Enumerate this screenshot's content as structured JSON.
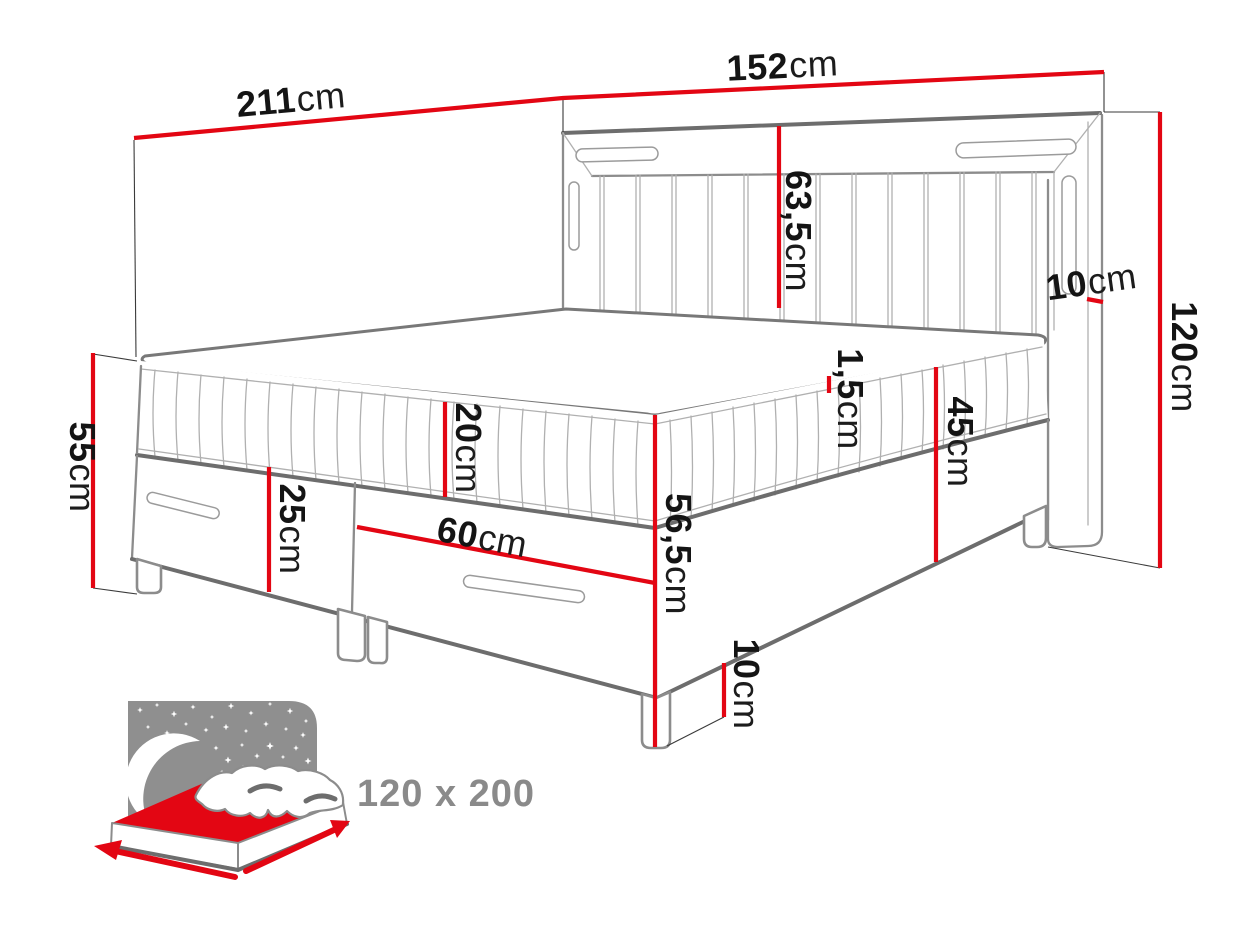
{
  "colors": {
    "background": "#ffffff",
    "dimension_red": "#e30613",
    "outline_gray": "#6d6d6d",
    "outline_light": "#9b9b9b",
    "text_black": "#141414",
    "badge_gray": "#8a8a8a"
  },
  "dimensions": {
    "total_width": {
      "value": "211",
      "unit": "cm"
    },
    "headboard_width": {
      "value": "152",
      "unit": "cm"
    },
    "headboard_panel_height": {
      "value": "63,5",
      "unit": "cm"
    },
    "headboard_side_depth": {
      "value": "10",
      "unit": "cm"
    },
    "headboard_height": {
      "value": "120",
      "unit": "cm"
    },
    "base_left_height": {
      "value": "55",
      "unit": "cm"
    },
    "mattress_height": {
      "value": "20",
      "unit": "cm"
    },
    "drawer_front_height": {
      "value": "25",
      "unit": "cm"
    },
    "drawer_width": {
      "value": "60",
      "unit": "cm"
    },
    "topper_edge_height": {
      "value": "1,5",
      "unit": "cm"
    },
    "side_rail_height": {
      "value": "45",
      "unit": "cm"
    },
    "corner_height": {
      "value": "56,5",
      "unit": "cm"
    },
    "leg_height": {
      "value": "10",
      "unit": "cm"
    }
  },
  "badge": {
    "size_label": "120 x 200"
  }
}
